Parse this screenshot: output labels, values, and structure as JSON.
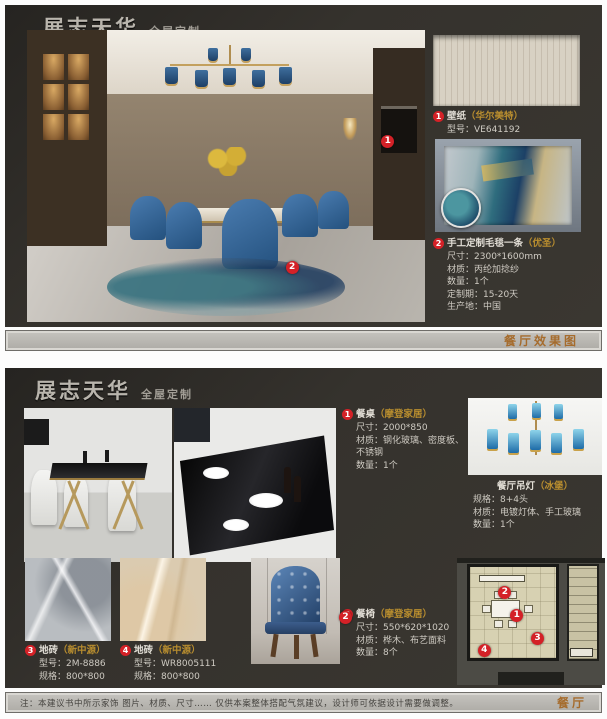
{
  "brand": {
    "logo": "展志天华",
    "tagline": "全屋定制"
  },
  "colors": {
    "accent_red": "#d42127",
    "accent_gold": "#b98e2f",
    "panel_bg": "#35322d",
    "text_light": "#cfcbc3",
    "stamp_orange": "#a4641f"
  },
  "top": {
    "stamp": "餐厅效果图",
    "markers": {
      "m1": "1",
      "m2": "2"
    },
    "wallpaper": {
      "num": "1",
      "title": "壁纸",
      "brand": "（华尔美特）",
      "lines": [
        {
          "label": "型号：",
          "value": "VE641192"
        }
      ]
    },
    "rug": {
      "num": "2",
      "title": "手工定制毛毯一条",
      "brand": "（优圣）",
      "lines": [
        {
          "label": "尺寸：",
          "value": "2300*1600mm"
        },
        {
          "label": "材质：",
          "value": "丙纶加捻纱"
        },
        {
          "label": "数量：",
          "value": "1个"
        },
        {
          "label": "定制期：",
          "value": "15-20天"
        },
        {
          "label": "生产地：",
          "value": "中国"
        }
      ]
    }
  },
  "bottom": {
    "table": {
      "num": "1",
      "title": "餐桌",
      "brand": "（摩登家居）",
      "lines": [
        {
          "label": "尺寸：",
          "value": "2000*850"
        },
        {
          "label": "材质：",
          "value": "钢化玻璃、密度板、不锈钢"
        },
        {
          "label": "数量：",
          "value": "1个"
        }
      ]
    },
    "chandelier": {
      "title": "餐厅吊灯",
      "brand": "（冰堡）",
      "lines": [
        {
          "label": "规格：",
          "value": "8+4头"
        },
        {
          "label": "材质：",
          "value": "电镀灯体、手工玻璃"
        },
        {
          "label": "数量：",
          "value": "1个"
        }
      ]
    },
    "tile1": {
      "num": "3",
      "title": "地砖",
      "brand": "（新中源）",
      "lines": [
        {
          "label": "型号：",
          "value": "2M-8886"
        },
        {
          "label": "规格：",
          "value": "800*800"
        }
      ]
    },
    "tile2": {
      "num": "4",
      "title": "地砖",
      "brand": "（新中源）",
      "lines": [
        {
          "label": "型号：",
          "value": "WR8005111"
        },
        {
          "label": "规格：",
          "value": "800*800"
        }
      ]
    },
    "chair": {
      "num": "2",
      "title": "餐椅",
      "brand": "（摩登家居）",
      "lines": [
        {
          "label": "尺寸：",
          "value": "550*620*1020"
        },
        {
          "label": "材质：",
          "value": "桦木、布艺面料"
        },
        {
          "label": "数量：",
          "value": "8个"
        }
      ]
    },
    "plan_markers": [
      "1",
      "2",
      "3",
      "4"
    ]
  },
  "footer": {
    "note": "注：本建议书中所示家饰 图片、材质、尺寸…… 仅供本案整体搭配气氛建议，设计师可依据设计需要做调整。",
    "stamp": "餐厅"
  }
}
